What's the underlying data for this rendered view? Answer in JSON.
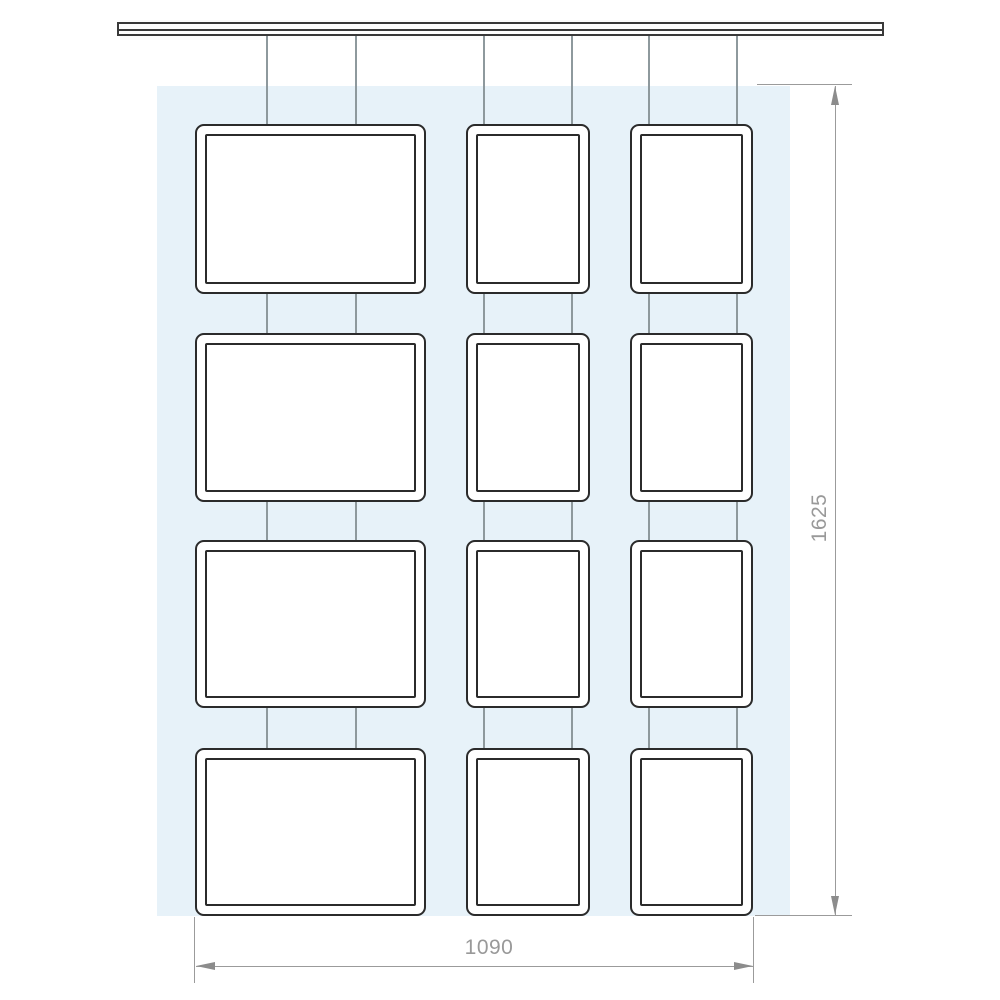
{
  "figure": {
    "type": "technical-line-drawing",
    "annotations": {
      "vertical_dimension": "1625",
      "horizontal_dimension": "1090"
    },
    "grid": {
      "rows": 4,
      "columns": 3,
      "frames_total": 12
    },
    "colors": {
      "background": "#ffffff",
      "backdrop_panel": "#e7f2f9",
      "frame_border": "#2b2b2b",
      "cable": "#8e999d",
      "rail_border": "#3a3a3a",
      "dimension_line": "#9b9b9b",
      "dimension_text": "#999999",
      "arrowhead": "#8c8c8c"
    }
  }
}
